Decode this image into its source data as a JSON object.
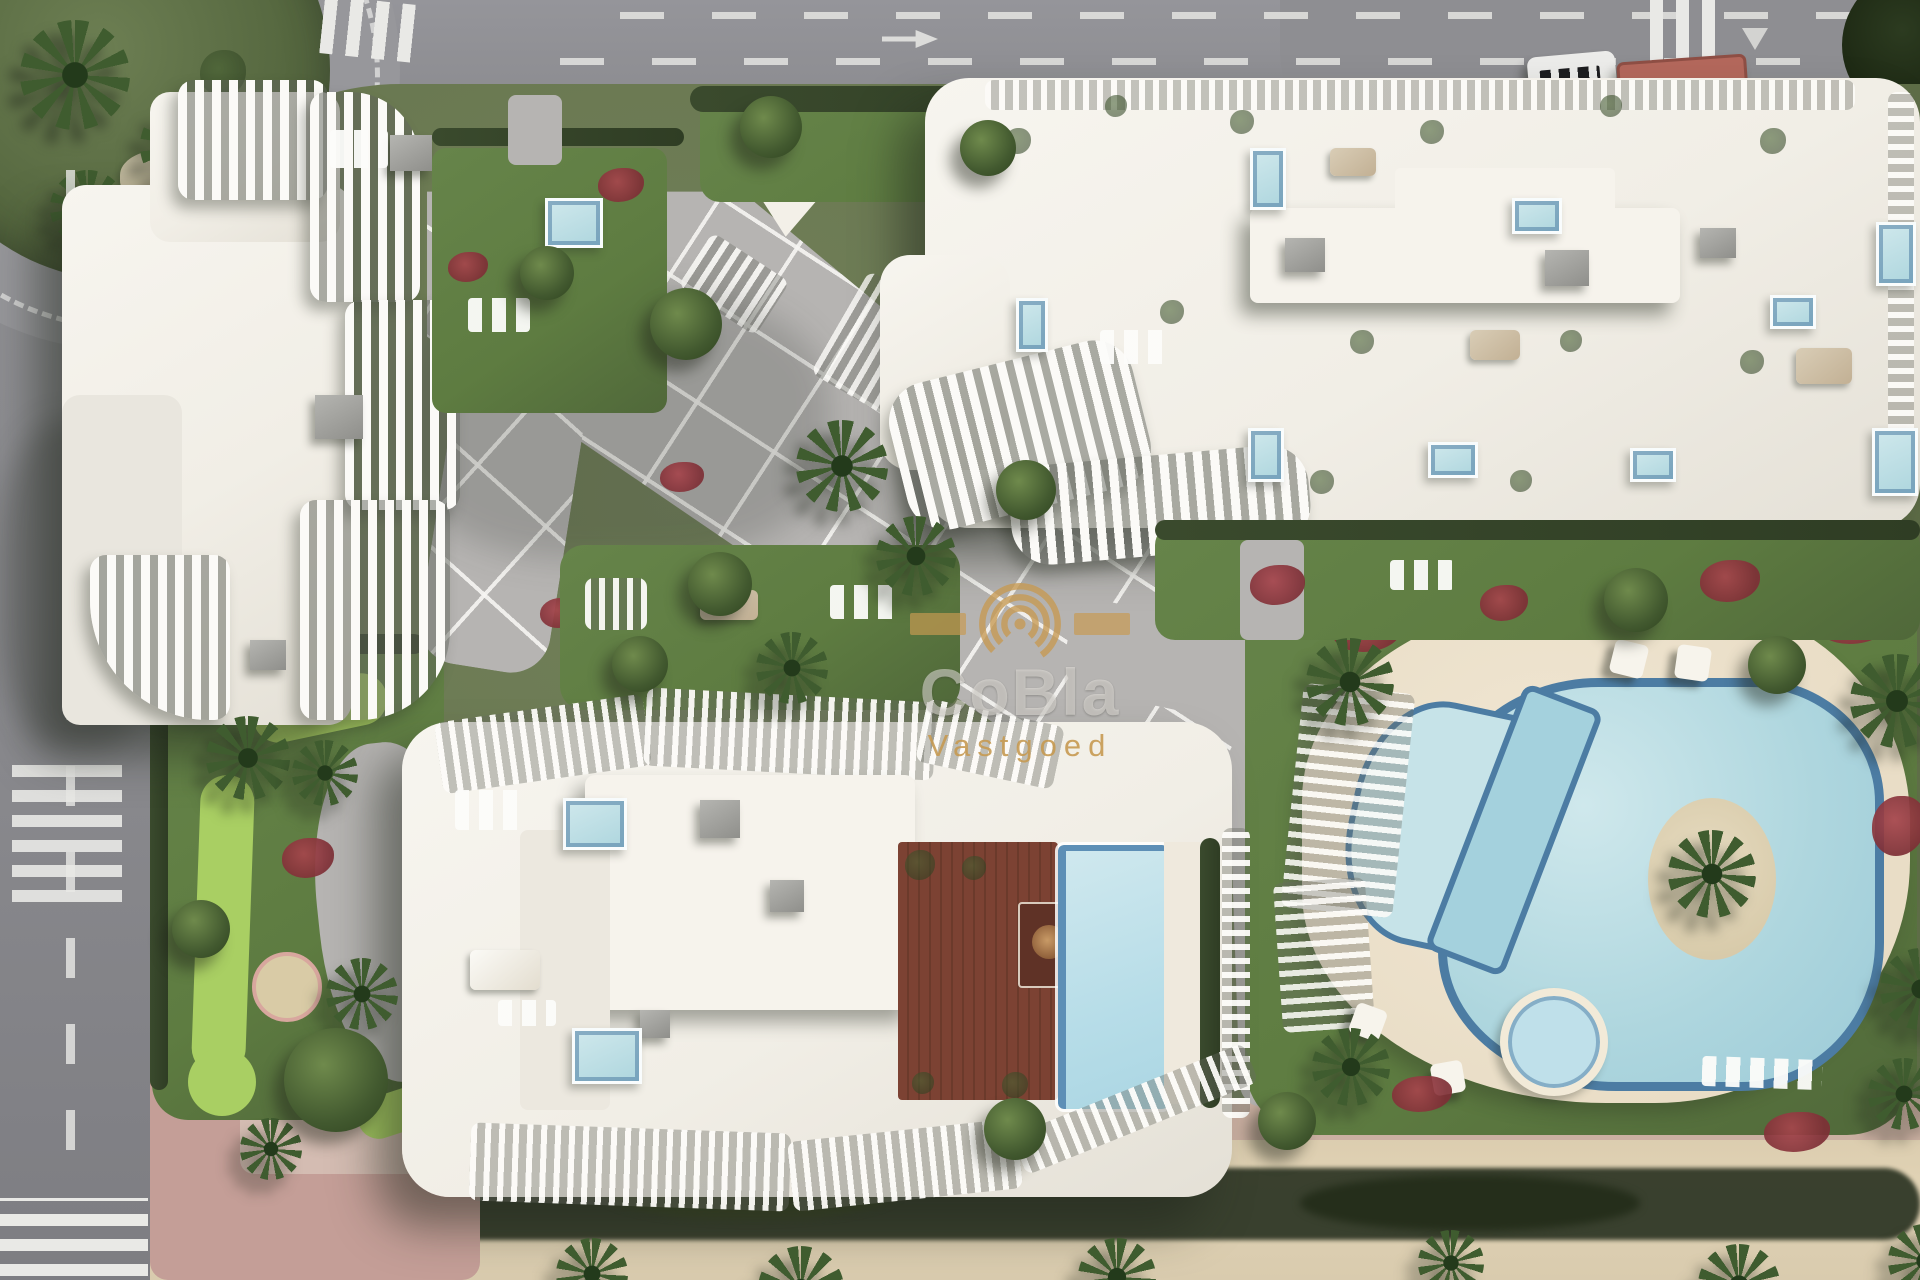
{
  "watermark": {
    "brand": "CoBla",
    "sub": "Vastgoed",
    "logo_icon": "concentric-arcs-icon"
  },
  "palette": {
    "asphalt": "#8f8f93",
    "asphalt-dark": "#77777c",
    "marking-white": "#e9e9e6",
    "parcel-green": "#6e7b52",
    "lawn-green": "#5e7c41",
    "lawn-bright": "#a9cf63",
    "hedge-dark": "#3a4a2d",
    "hedge-band": "#2c3423",
    "palm-green": "#3f5c2f",
    "paving-gray": "#b6b4b2",
    "sidewalk-pink": "#c49e97",
    "sand": "#e0d2b4",
    "deck-cream": "#e9ddc6",
    "pool-water": "#aed6de",
    "pool-light": "#cfe8ec",
    "pool-rim": "#4c7ca3",
    "pool-small": "#7fc2d8",
    "building-white": "#f1eee6",
    "roof-bright": "#f6f3ec",
    "deck-brown": "#7c4233",
    "deck-brown-dark": "#5f3226",
    "kiosk-red": "#b4685c",
    "watermark-gold": "#c79a52"
  }
}
